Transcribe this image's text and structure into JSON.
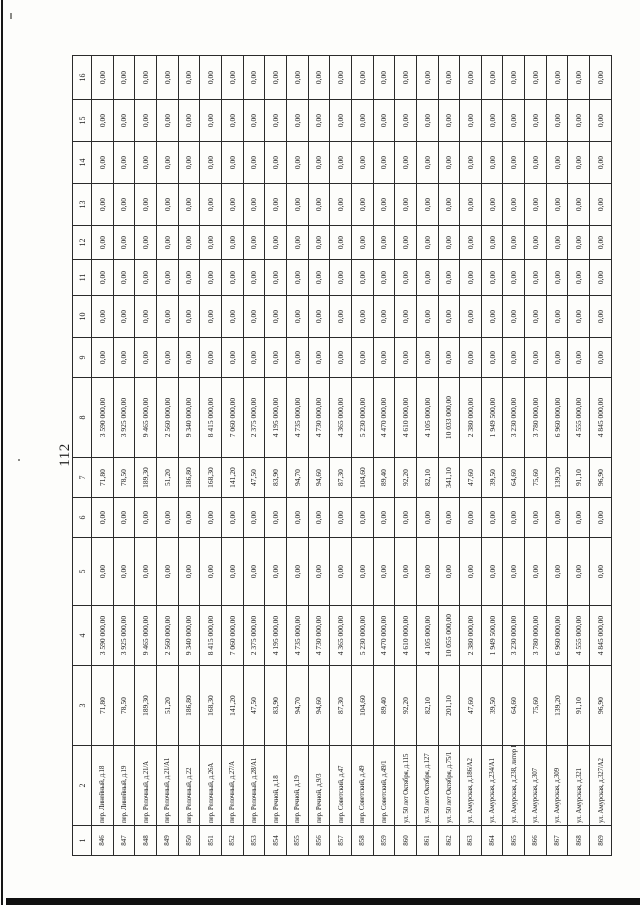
{
  "page": {
    "number": "112"
  },
  "colors": {
    "paper": "#fdfdfb",
    "ink": "#1c1c1c",
    "border": "#2b2b2b",
    "scan_edge": "#101010"
  },
  "table": {
    "orientation": "rotated-90-ccw",
    "header": [
      "1",
      "2",
      "3",
      "4",
      "5",
      "6",
      "7",
      "8",
      "9",
      "10",
      "11",
      "12",
      "13",
      "14",
      "15",
      "16"
    ],
    "rows": [
      [
        "846",
        "пер. Линейный, д.18",
        "71,80",
        "3 590 000,00",
        "0,00",
        "0,00",
        "71,80",
        "3 590 000,00",
        "0,00",
        "0,00",
        "0,00",
        "0,00",
        "0,00",
        "0,00",
        "0,00",
        "0,00"
      ],
      [
        "847",
        "пер. Линейный, д.19",
        "78,50",
        "3 925 000,00",
        "0,00",
        "0,00",
        "78,50",
        "3 925 000,00",
        "0,00",
        "0,00",
        "0,00",
        "0,00",
        "0,00",
        "0,00",
        "0,00",
        "0,00"
      ],
      [
        "848",
        "пер. Релочный, д.21/А",
        "189,30",
        "9 465 000,00",
        "0,00",
        "0,00",
        "189,30",
        "9 465 000,00",
        "0,00",
        "0,00",
        "0,00",
        "0,00",
        "0,00",
        "0,00",
        "0,00",
        "0,00"
      ],
      [
        "849",
        "пер. Релочный, д.21/А1",
        "51,20",
        "2 560 000,00",
        "0,00",
        "0,00",
        "51,20",
        "2 560 000,00",
        "0,00",
        "0,00",
        "0,00",
        "0,00",
        "0,00",
        "0,00",
        "0,00",
        "0,00"
      ],
      [
        "850",
        "пер. Релочный, д.22",
        "186,80",
        "9 340 000,00",
        "0,00",
        "0,00",
        "186,80",
        "9 340 000,00",
        "0,00",
        "0,00",
        "0,00",
        "0,00",
        "0,00",
        "0,00",
        "0,00",
        "0,00"
      ],
      [
        "851",
        "пер. Релочный, д.26А",
        "168,30",
        "8 415 000,00",
        "0,00",
        "0,00",
        "168,30",
        "8 415 000,00",
        "0,00",
        "0,00",
        "0,00",
        "0,00",
        "0,00",
        "0,00",
        "0,00",
        "0,00"
      ],
      [
        "852",
        "пер. Релочный, д.27/А",
        "141,20",
        "7 060 000,00",
        "0,00",
        "0,00",
        "141,20",
        "7 060 000,00",
        "0,00",
        "0,00",
        "0,00",
        "0,00",
        "0,00",
        "0,00",
        "0,00",
        "0,00"
      ],
      [
        "853",
        "пер. Релочный, д.28/А1",
        "47,50",
        "2 375 000,00",
        "0,00",
        "0,00",
        "47,50",
        "2 375 000,00",
        "0,00",
        "0,00",
        "0,00",
        "0,00",
        "0,00",
        "0,00",
        "0,00",
        "0,00"
      ],
      [
        "854",
        "пер. Речной, д.18",
        "83,90",
        "4 195 000,00",
        "0,00",
        "0,00",
        "83,90",
        "4 195 000,00",
        "0,00",
        "0,00",
        "0,00",
        "0,00",
        "0,00",
        "0,00",
        "0,00",
        "0,00"
      ],
      [
        "855",
        "пер. Речной, д.19",
        "94,70",
        "4 735 000,00",
        "0,00",
        "0,00",
        "94,70",
        "4 735 000,00",
        "0,00",
        "0,00",
        "0,00",
        "0,00",
        "0,00",
        "0,00",
        "0,00",
        "0,00"
      ],
      [
        "856",
        "пер. Речной, д.9/3",
        "94,60",
        "4 730 000,00",
        "0,00",
        "0,00",
        "94,60",
        "4 730 000,00",
        "0,00",
        "0,00",
        "0,00",
        "0,00",
        "0,00",
        "0,00",
        "0,00",
        "0,00"
      ],
      [
        "857",
        "пер. Советский, д.47",
        "87,30",
        "4 365 000,00",
        "0,00",
        "0,00",
        "87,30",
        "4 365 000,00",
        "0,00",
        "0,00",
        "0,00",
        "0,00",
        "0,00",
        "0,00",
        "0,00",
        "0,00"
      ],
      [
        "858",
        "пер. Советский, д.49",
        "104,60",
        "5 230 000,00",
        "0,00",
        "0,00",
        "104,60",
        "5 230 000,00",
        "0,00",
        "0,00",
        "0,00",
        "0,00",
        "0,00",
        "0,00",
        "0,00",
        "0,00"
      ],
      [
        "859",
        "пер. Советский, д.49/1",
        "89,40",
        "4 470 000,00",
        "0,00",
        "0,00",
        "89,40",
        "4 470 000,00",
        "0,00",
        "0,00",
        "0,00",
        "0,00",
        "0,00",
        "0,00",
        "0,00",
        "0,00"
      ],
      [
        "860",
        "ул. 50 лет Октября, д.115",
        "92,20",
        "4 610 000,00",
        "0,00",
        "0,00",
        "92,20",
        "4 610 000,00",
        "0,00",
        "0,00",
        "0,00",
        "0,00",
        "0,00",
        "0,00",
        "0,00",
        "0,00"
      ],
      [
        "861",
        "ул. 50 лет Октября, д.127",
        "82,10",
        "4 105 000,00",
        "0,00",
        "0,00",
        "82,10",
        "4 105 000,00",
        "0,00",
        "0,00",
        "0,00",
        "0,00",
        "0,00",
        "0,00",
        "0,00",
        "0,00"
      ],
      [
        "862",
        "ул. 50 лет Октября, д.75/1",
        "201,10",
        "10 055 000,00",
        "0,00",
        "0,00",
        "341,10",
        "10 033 000,00",
        "0,00",
        "0,00",
        "0,00",
        "0,00",
        "0,00",
        "0,00",
        "0,00",
        "0,00"
      ],
      [
        "863",
        "ул. Амурская, д.186/А2",
        "47,60",
        "2 380 000,00",
        "0,00",
        "0,00",
        "47,60",
        "2 380 000,00",
        "0,00",
        "0,00",
        "0,00",
        "0,00",
        "0,00",
        "0,00",
        "0,00",
        "0,00"
      ],
      [
        "864",
        "ул. Амурская, д.234/А1",
        "39,50",
        "1 949 500,00",
        "0,00",
        "0,00",
        "39,50",
        "1 949 500,00",
        "0,00",
        "0,00",
        "0,00",
        "0,00",
        "0,00",
        "0,00",
        "0,00",
        "0,00"
      ],
      [
        "865",
        "ул. Амурская, д.238, литер Б",
        "64,60",
        "3 230 000,00",
        "0,00",
        "0,00",
        "64,60",
        "3 230 000,00",
        "0,00",
        "0,00",
        "0,00",
        "0,00",
        "0,00",
        "0,00",
        "0,00",
        "0,00"
      ],
      [
        "866",
        "ул. Амурская, д.307",
        "75,60",
        "3 780 000,00",
        "0,00",
        "0,00",
        "75,60",
        "3 780 000,00",
        "0,00",
        "0,00",
        "0,00",
        "0,00",
        "0,00",
        "0,00",
        "0,00",
        "0,00"
      ],
      [
        "867",
        "ул. Амурская, д.309",
        "139,20",
        "6 960 000,00",
        "0,00",
        "0,00",
        "139,20",
        "6 960 000,00",
        "0,00",
        "0,00",
        "0,00",
        "0,00",
        "0,00",
        "0,00",
        "0,00",
        "0,00"
      ],
      [
        "868",
        "ул. Амурская, д.321",
        "91,10",
        "4 555 000,00",
        "0,00",
        "0,00",
        "91,10",
        "4 555 000,00",
        "0,00",
        "0,00",
        "0,00",
        "0,00",
        "0,00",
        "0,00",
        "0,00",
        "0,00"
      ],
      [
        "869",
        "ул. Амурская, д.327/А2",
        "96,90",
        "4 845 000,00",
        "0,00",
        "0,00",
        "96,90",
        "4 845 000,00",
        "0,00",
        "0,00",
        "0,00",
        "0,00",
        "0,00",
        "0,00",
        "0,00",
        "0,00"
      ]
    ]
  }
}
